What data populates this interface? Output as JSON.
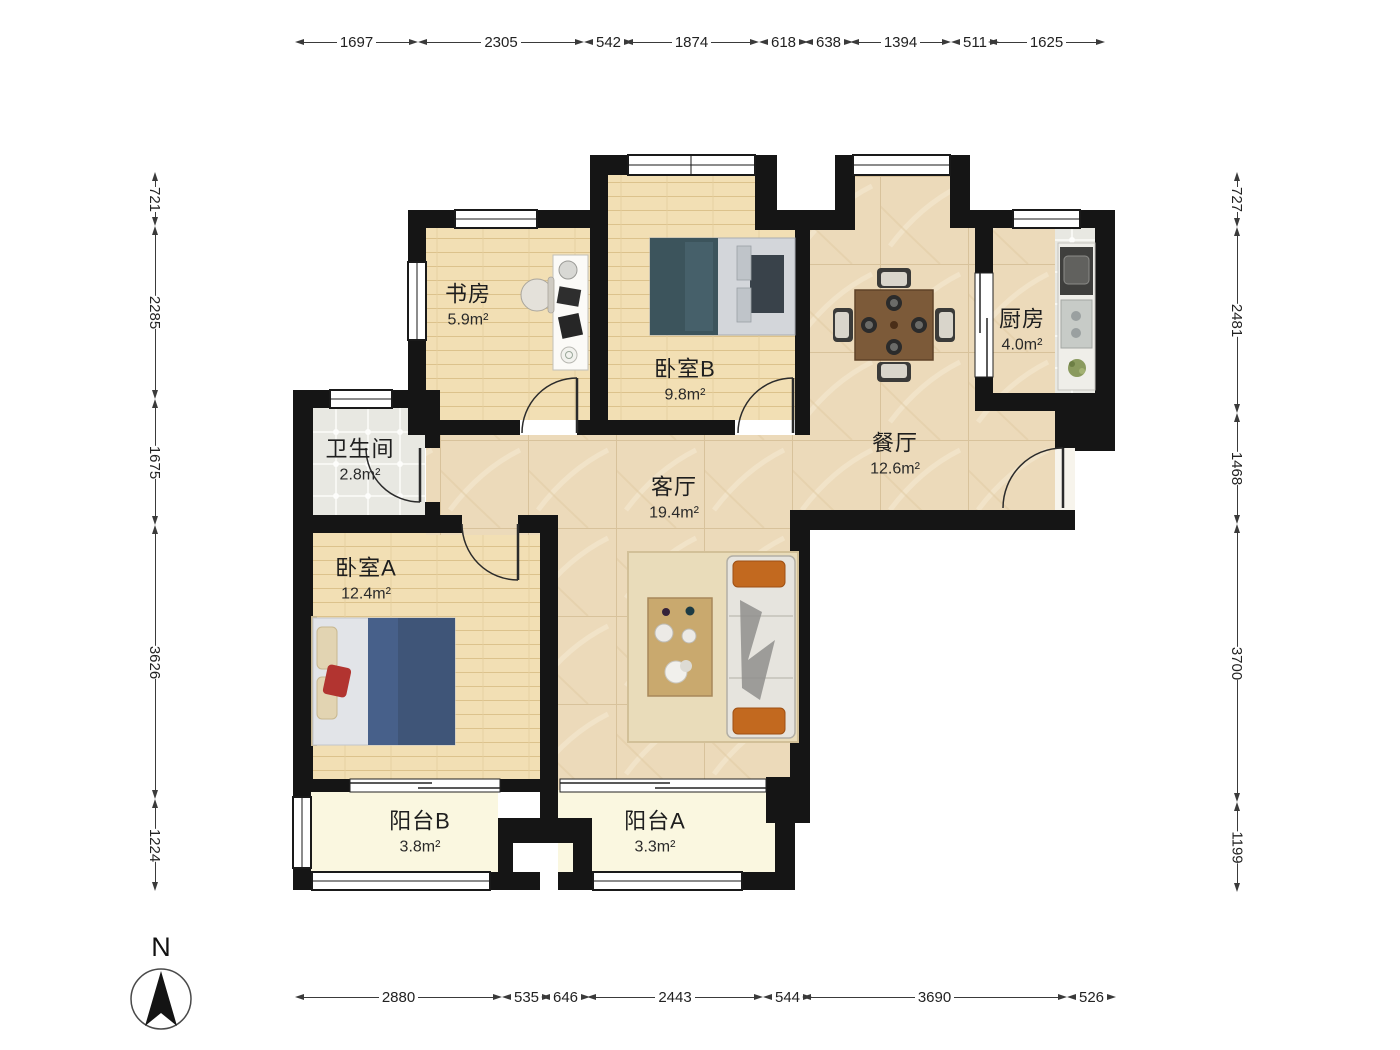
{
  "compass": {
    "label": "N"
  },
  "rooms": [
    {
      "id": "study",
      "name": "书房",
      "area": "5.9m²"
    },
    {
      "id": "bedroom-b",
      "name": "卧室B",
      "area": "9.8m²"
    },
    {
      "id": "kitchen",
      "name": "厨房",
      "area": "4.0m²"
    },
    {
      "id": "dining",
      "name": "餐厅",
      "area": "12.6m²"
    },
    {
      "id": "bathroom",
      "name": "卫生间",
      "area": "2.8m²"
    },
    {
      "id": "living",
      "name": "客厅",
      "area": "19.4m²"
    },
    {
      "id": "bedroom-a",
      "name": "卧室A",
      "area": "12.4m²"
    },
    {
      "id": "balcony-b",
      "name": "阳台B",
      "area": "3.8m²"
    },
    {
      "id": "balcony-a",
      "name": "阳台A",
      "area": "3.3m²"
    }
  ],
  "dims": {
    "top": [
      "1697",
      "2305",
      "542",
      "1874",
      "618",
      "638",
      "1394",
      "511",
      "1625"
    ],
    "bottom": [
      "2880",
      "535",
      "646",
      "2443",
      "544",
      "3690",
      "526"
    ],
    "left": [
      "721",
      "2285",
      "1675",
      "3626",
      "1224"
    ],
    "right": [
      "727",
      "2481",
      "1468",
      "3700",
      "1199"
    ]
  }
}
